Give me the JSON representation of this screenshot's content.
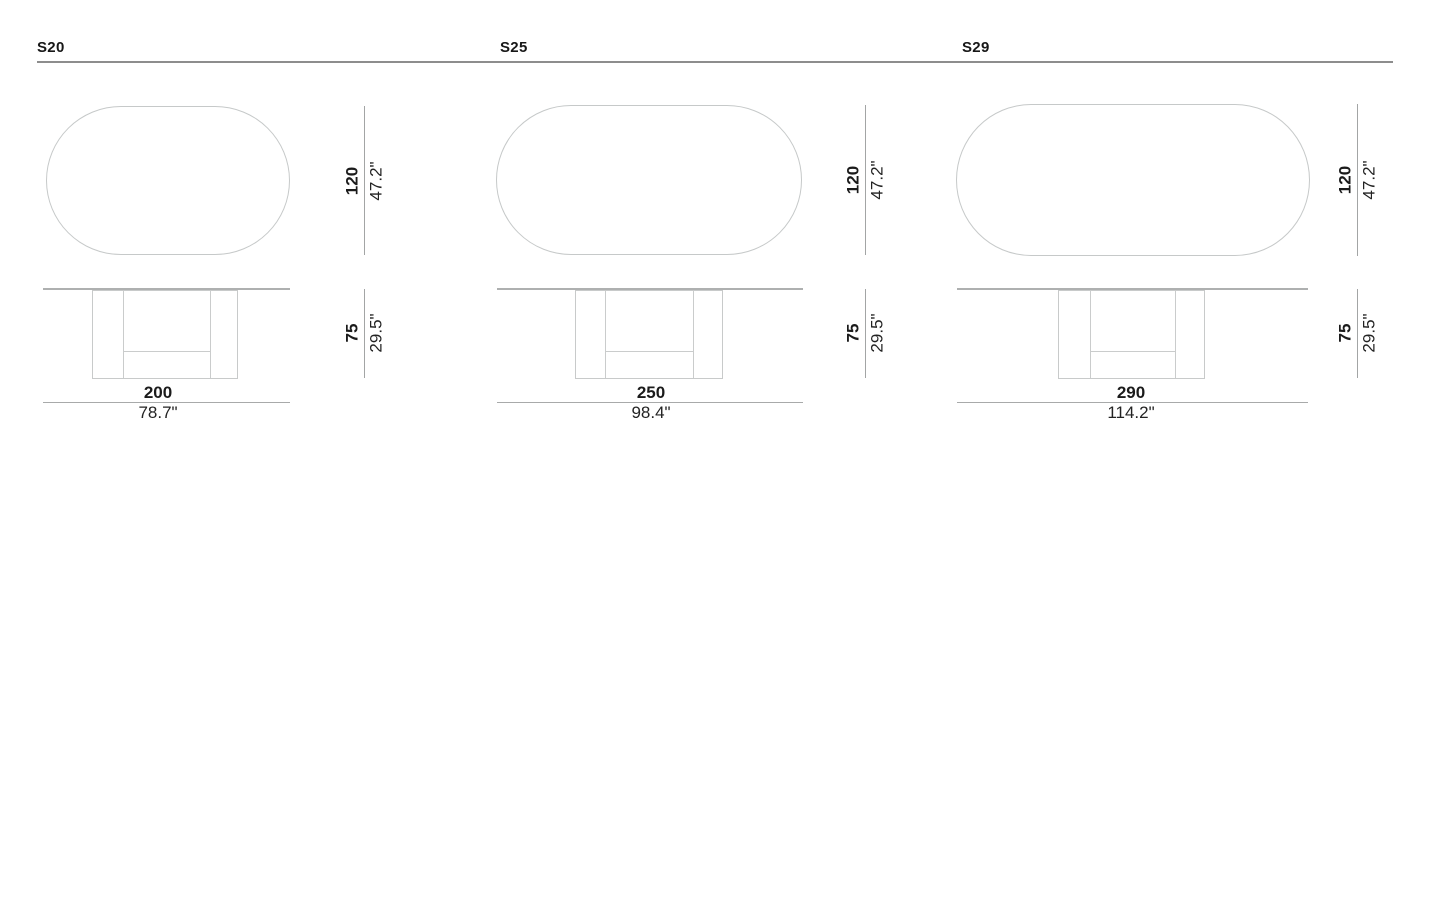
{
  "products": [
    {
      "model": "S20",
      "depth": {
        "metric": "120",
        "imperial": "47.2\""
      },
      "height": {
        "metric": "75",
        "imperial": "29.5\""
      },
      "length": {
        "metric": "200",
        "imperial": "78.7\""
      }
    },
    {
      "model": "S25",
      "depth": {
        "metric": "120",
        "imperial": "47.2\""
      },
      "height": {
        "metric": "75",
        "imperial": "29.5\""
      },
      "length": {
        "metric": "250",
        "imperial": "98.4\""
      }
    },
    {
      "model": "S29",
      "depth": {
        "metric": "120",
        "imperial": "47.2\""
      },
      "height": {
        "metric": "75",
        "imperial": "29.5\""
      },
      "length": {
        "metric": "290",
        "imperial": "114.2\""
      }
    }
  ]
}
